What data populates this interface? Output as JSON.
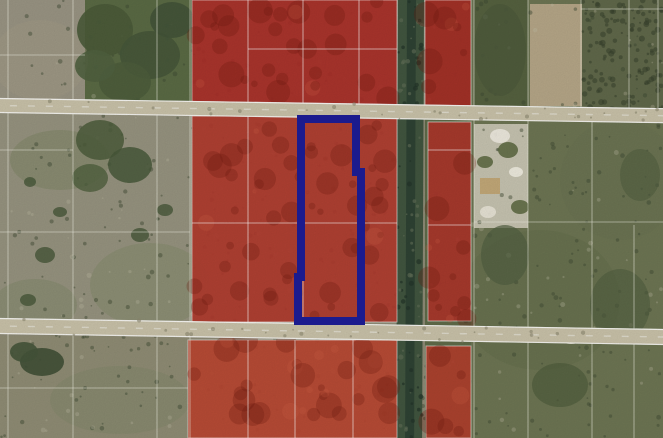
{
  "map": {
    "kind": "aerial-parcel-map",
    "canvas": {
      "width": 663,
      "height": 438
    },
    "colors": {
      "red_overlay": "#b23a2c",
      "subject_outline": "#1b1b8e",
      "road_surface": "#c9c2a9",
      "canal": "#41553f",
      "canal_core": "#2e4233",
      "parcel_line": "#ffffff",
      "field_base": "#8e8b76",
      "vegetation": "#6d7553",
      "tree": "#4a5a39"
    },
    "terrain": [
      {
        "name": "base-field",
        "x": 0,
        "y": 0,
        "w": 663,
        "h": 438,
        "fill": "#8e8b76"
      },
      {
        "name": "field-top-left",
        "x": 0,
        "y": 0,
        "w": 192,
        "h": 103,
        "fill": "#999483"
      },
      {
        "name": "trees-top-left-block",
        "x": 85,
        "y": 0,
        "w": 107,
        "h": 103,
        "fill": "#5a6a44"
      },
      {
        "name": "field-mid-left",
        "x": 0,
        "y": 113,
        "w": 192,
        "h": 209,
        "fill": "#96937f"
      },
      {
        "name": "field-bottom-left",
        "x": 0,
        "y": 336,
        "w": 192,
        "h": 102,
        "fill": "#8f8c74"
      },
      {
        "name": "vegetation-east",
        "x": 471,
        "y": 0,
        "w": 192,
        "h": 438,
        "fill": "#6d7553"
      },
      {
        "name": "strip-east-of-canal",
        "x": 425,
        "y": 0,
        "w": 46,
        "h": 438,
        "fill": "#5f6b49"
      },
      {
        "name": "treed-parcel-topright",
        "x": 474,
        "y": 0,
        "w": 54,
        "h": 112,
        "fill": "#55613f"
      },
      {
        "name": "dirt-field-topright",
        "x": 530,
        "y": 4,
        "w": 52,
        "h": 102,
        "fill": "#b5a687"
      },
      {
        "name": "dark-scrub-topright",
        "x": 582,
        "y": 0,
        "w": 81,
        "h": 110,
        "fill": "#60684a"
      },
      {
        "name": "sandy-parcel-east",
        "x": 474,
        "y": 124,
        "w": 54,
        "h": 104,
        "fill": "#c6c3b0"
      }
    ],
    "tint_blobs": [
      {
        "name": "grass-tint",
        "cx": 60,
        "cy": 160,
        "rx": 50,
        "ry": 30,
        "fill": "#6d7a52",
        "opacity": 0.3
      },
      {
        "name": "grass-tint",
        "cx": 150,
        "cy": 285,
        "rx": 60,
        "ry": 42,
        "fill": "#74815a",
        "opacity": 0.28
      },
      {
        "name": "grass-tint",
        "cx": 35,
        "cy": 305,
        "rx": 42,
        "ry": 26,
        "fill": "#6d7a52",
        "opacity": 0.25
      },
      {
        "name": "grass-tint",
        "cx": 120,
        "cy": 400,
        "rx": 70,
        "ry": 34,
        "fill": "#798363",
        "opacity": 0.3
      },
      {
        "name": "sand-tint",
        "cx": 40,
        "cy": 60,
        "rx": 48,
        "ry": 40,
        "fill": "#a29a86",
        "opacity": 0.4
      },
      {
        "name": "sand-tint",
        "cx": 260,
        "cy": 395,
        "rx": 46,
        "ry": 30,
        "fill": "#a0642f",
        "opacity": 0.0
      },
      {
        "name": "grass-tint",
        "cx": 540,
        "cy": 300,
        "rx": 80,
        "ry": 70,
        "fill": "#5f6a49",
        "opacity": 0.35
      },
      {
        "name": "grass-tint",
        "cx": 620,
        "cy": 180,
        "rx": 60,
        "ry": 60,
        "fill": "#66714e",
        "opacity": 0.3
      }
    ],
    "tree_clusters": [
      {
        "name": "tree-canopy",
        "cx": 105,
        "cy": 30,
        "rx": 28,
        "ry": 26,
        "fill": "#4a5a39",
        "opacity": 0.9
      },
      {
        "name": "tree-canopy",
        "cx": 150,
        "cy": 55,
        "rx": 30,
        "ry": 24,
        "fill": "#46563a",
        "opacity": 0.9
      },
      {
        "name": "tree-canopy",
        "cx": 125,
        "cy": 82,
        "rx": 26,
        "ry": 20,
        "fill": "#4d5d3c",
        "opacity": 0.9
      },
      {
        "name": "tree-canopy",
        "cx": 172,
        "cy": 20,
        "rx": 22,
        "ry": 18,
        "fill": "#435338",
        "opacity": 0.9
      },
      {
        "name": "tree-canopy",
        "cx": 95,
        "cy": 66,
        "rx": 20,
        "ry": 16,
        "fill": "#50603f",
        "opacity": 0.9
      },
      {
        "name": "tree-canopy",
        "cx": 100,
        "cy": 140,
        "rx": 24,
        "ry": 20,
        "fill": "#4c5c3b",
        "opacity": 0.85
      },
      {
        "name": "tree-canopy",
        "cx": 130,
        "cy": 165,
        "rx": 22,
        "ry": 18,
        "fill": "#48583a",
        "opacity": 0.85
      },
      {
        "name": "tree-canopy",
        "cx": 90,
        "cy": 178,
        "rx": 18,
        "ry": 14,
        "fill": "#50603f",
        "opacity": 0.8
      },
      {
        "name": "bush",
        "cx": 45,
        "cy": 255,
        "rx": 10,
        "ry": 8,
        "fill": "#47573a",
        "opacity": 0.8
      },
      {
        "name": "bush",
        "cx": 28,
        "cy": 300,
        "rx": 8,
        "ry": 6,
        "fill": "#47573a",
        "opacity": 0.8
      },
      {
        "name": "bush",
        "cx": 140,
        "cy": 235,
        "rx": 9,
        "ry": 7,
        "fill": "#47573a",
        "opacity": 0.8
      },
      {
        "name": "bush",
        "cx": 165,
        "cy": 210,
        "rx": 8,
        "ry": 6,
        "fill": "#47573a",
        "opacity": 0.8
      },
      {
        "name": "bush",
        "cx": 60,
        "cy": 212,
        "rx": 7,
        "ry": 5,
        "fill": "#47573a",
        "opacity": 0.8
      },
      {
        "name": "bush",
        "cx": 30,
        "cy": 182,
        "rx": 6,
        "ry": 5,
        "fill": "#47573a",
        "opacity": 0.8
      },
      {
        "name": "tree-canopy",
        "cx": 42,
        "cy": 362,
        "rx": 22,
        "ry": 14,
        "fill": "#404f36",
        "opacity": 0.9
      },
      {
        "name": "tree-canopy",
        "cx": 24,
        "cy": 352,
        "rx": 14,
        "ry": 10,
        "fill": "#45543a",
        "opacity": 0.9
      },
      {
        "name": "tree-canopy",
        "cx": 500,
        "cy": 50,
        "rx": 26,
        "ry": 46,
        "fill": "#4d5a3c",
        "opacity": 0.8
      },
      {
        "name": "tree-canopy",
        "cx": 505,
        "cy": 255,
        "rx": 24,
        "ry": 30,
        "fill": "#515f41",
        "opacity": 0.7
      },
      {
        "name": "tree-canopy",
        "cx": 620,
        "cy": 305,
        "rx": 30,
        "ry": 36,
        "fill": "#505e40",
        "opacity": 0.6
      },
      {
        "name": "tree-canopy",
        "cx": 560,
        "cy": 385,
        "rx": 28,
        "ry": 22,
        "fill": "#4b5939",
        "opacity": 0.6
      },
      {
        "name": "tree-canopy",
        "cx": 640,
        "cy": 175,
        "rx": 20,
        "ry": 26,
        "fill": "#515f41",
        "opacity": 0.6
      },
      {
        "name": "bush",
        "cx": 508,
        "cy": 150,
        "rx": 10,
        "ry": 8,
        "fill": "#5f6b45",
        "opacity": 0.9
      },
      {
        "name": "bush",
        "cx": 485,
        "cy": 162,
        "rx": 8,
        "ry": 6,
        "fill": "#5f6b45",
        "opacity": 0.9
      },
      {
        "name": "bush",
        "cx": 520,
        "cy": 207,
        "rx": 9,
        "ry": 7,
        "fill": "#5f6b45",
        "opacity": 0.9
      }
    ],
    "landmarks": [
      {
        "name": "building",
        "shape": "rect",
        "x": 480,
        "y": 178,
        "w": 20,
        "h": 16,
        "fill": "#c2a878",
        "opacity": 1
      },
      {
        "name": "sand-patch",
        "shape": "ellipse",
        "cx": 500,
        "cy": 136,
        "rx": 10,
        "ry": 7,
        "fill": "#eeeadf",
        "opacity": 0.95
      },
      {
        "name": "sand-patch",
        "shape": "ellipse",
        "cx": 488,
        "cy": 212,
        "rx": 8,
        "ry": 6,
        "fill": "#e8e4d6",
        "opacity": 0.95
      },
      {
        "name": "sand-patch",
        "shape": "ellipse",
        "cx": 516,
        "cy": 172,
        "rx": 7,
        "ry": 5,
        "fill": "#efecdf",
        "opacity": 0.95
      },
      {
        "name": "sand-patch",
        "shape": "ellipse",
        "cx": 545,
        "cy": 336,
        "rx": 12,
        "ry": 6,
        "fill": "#ddd9c8",
        "opacity": 0.9
      },
      {
        "name": "sand-patch",
        "shape": "ellipse",
        "cx": 571,
        "cy": 339,
        "rx": 10,
        "ry": 5,
        "fill": "#d8d4c3",
        "opacity": 0.9
      },
      {
        "name": "road-trees",
        "shape": "ellipse",
        "cx": 120,
        "cy": 106,
        "rx": 16,
        "ry": 7,
        "fill": "#4f5b3e",
        "opacity": 0.95
      },
      {
        "name": "road-trees",
        "shape": "ellipse",
        "cx": 96,
        "cy": 109,
        "rx": 11,
        "ry": 5,
        "fill": "#54603f",
        "opacity": 0.95
      },
      {
        "name": "road-trees",
        "shape": "ellipse",
        "cx": 390,
        "cy": 333,
        "rx": 13,
        "ry": 7,
        "fill": "#46523a",
        "opacity": 0.95
      },
      {
        "name": "road-trees",
        "shape": "ellipse",
        "cx": 358,
        "cy": 331,
        "rx": 9,
        "ry": 5,
        "fill": "#4c583b",
        "opacity": 0.95
      },
      {
        "name": "road-trees",
        "shape": "ellipse",
        "cx": 300,
        "cy": 101,
        "rx": 14,
        "ry": 5,
        "fill": "#7d8263",
        "opacity": 0.8
      }
    ],
    "canal": {
      "name": "canal",
      "x": 398,
      "y": -4,
      "w": 26,
      "h": 446,
      "tilt": 0.25,
      "core_x": 407,
      "core_w": 9
    },
    "roads": [
      {
        "name": "road-1",
        "y": 98,
        "h": 15,
        "tilt": 0.88
      },
      {
        "name": "road-2",
        "y": 318,
        "h": 16,
        "tilt": 0.95
      }
    ],
    "red_parcels": [
      {
        "name": "red-parcel-nw",
        "x": 192,
        "y": 0,
        "w": 205,
        "h": 110,
        "fill": "#ab2d26"
      },
      {
        "name": "red-parcel-ne",
        "x": 425,
        "y": 0,
        "w": 46,
        "h": 114,
        "fill": "#a82c25"
      },
      {
        "name": "red-parcel-w",
        "x": 192,
        "y": 116,
        "w": 205,
        "h": 206,
        "fill": "#b23a2c"
      },
      {
        "name": "red-parcel-e",
        "x": 428,
        "y": 122,
        "w": 43,
        "h": 199,
        "fill": "#ad352a"
      },
      {
        "name": "red-parcel-sw",
        "x": 188,
        "y": 340,
        "w": 209,
        "h": 98,
        "fill": "#bb4530"
      },
      {
        "name": "red-parcel-se",
        "x": 426,
        "y": 346,
        "w": 45,
        "h": 92,
        "fill": "#b23f2c"
      }
    ],
    "red_parcel_lines": {
      "vertical": [
        {
          "x": 248,
          "y1": 0,
          "y2": 322
        },
        {
          "x": 303,
          "y1": 0,
          "y2": 322
        },
        {
          "x": 359,
          "y1": 0,
          "y2": 116
        },
        {
          "x": 248,
          "y1": 340,
          "y2": 438
        },
        {
          "x": 295,
          "y1": 340,
          "y2": 438
        },
        {
          "x": 353,
          "y1": 340,
          "y2": 438
        }
      ],
      "horizontal": [
        {
          "y": 49,
          "x1": 248,
          "x2": 397
        },
        {
          "y": 223,
          "x1": 192,
          "x2": 397
        },
        {
          "y": 150,
          "x1": 428,
          "x2": 471
        },
        {
          "y": 225,
          "x1": 428,
          "x2": 471
        }
      ]
    },
    "parcel_lines": {
      "vertical": [
        {
          "x": 8,
          "y1": 0,
          "y2": 438
        },
        {
          "x": 73,
          "y1": 0,
          "y2": 438
        },
        {
          "x": 157,
          "y1": 0,
          "y2": 438
        },
        {
          "x": 190,
          "y1": 0,
          "y2": 438
        },
        {
          "x": 474,
          "y1": 0,
          "y2": 438
        },
        {
          "x": 528,
          "y1": 0,
          "y2": 438
        },
        {
          "x": 581,
          "y1": 0,
          "y2": 112
        },
        {
          "x": 592,
          "y1": 112,
          "y2": 438
        },
        {
          "x": 629,
          "y1": 0,
          "y2": 112
        },
        {
          "x": 634,
          "y1": 225,
          "y2": 438
        },
        {
          "x": 658,
          "y1": 0,
          "y2": 112
        }
      ],
      "horizontal": [
        {
          "y": 55,
          "x1": 0,
          "x2": 85
        },
        {
          "y": 150,
          "x1": 0,
          "x2": 73
        },
        {
          "y": 232,
          "x1": 0,
          "x2": 190
        },
        {
          "y": 388,
          "x1": 0,
          "x2": 188
        },
        {
          "y": 9,
          "x1": 581,
          "x2": 663
        },
        {
          "y": 222,
          "x1": 474,
          "x2": 663
        }
      ]
    },
    "subject_parcel": {
      "name": "subject-parcel-outline",
      "path": "M301,119 L356,119 L356,172 L361,172 L361,321 L298,321 L298,277 L301,277 Z",
      "stroke": "#1b1b8e",
      "stroke_width": 8
    },
    "texture": {
      "seed": 42,
      "speckles_dark": 520,
      "speckles_light": 150,
      "dense_dark_region": {
        "x": 582,
        "y": 0,
        "w": 81,
        "h": 110,
        "count": 130
      },
      "blotch_dark_fill": "#701a10",
      "blotch_light_fill": "#d4624a"
    }
  }
}
